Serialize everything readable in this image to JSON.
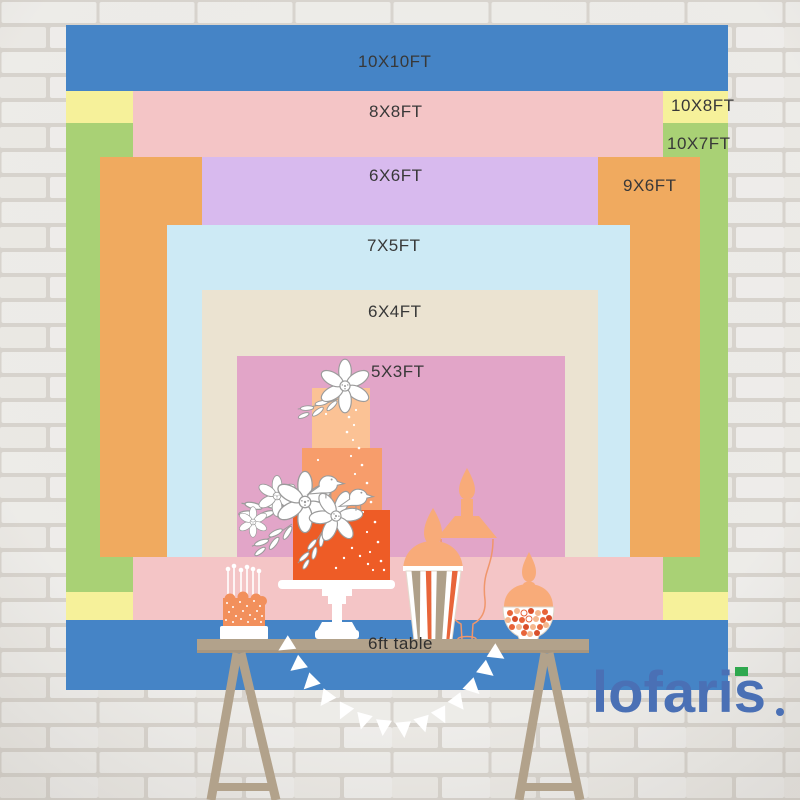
{
  "page": {
    "description": "backdrop size comparison chart on white brick wall with dessert table illustration"
  },
  "size_chart": {
    "layers": [
      {
        "label": "10X10FT",
        "color": "#4584c6"
      },
      {
        "label": "8X8FT",
        "color": "#f4c5c6"
      },
      {
        "label": "10X8FT",
        "color": "#f6f19a"
      },
      {
        "label": "10X7FT",
        "color": "#a9d175"
      },
      {
        "label": "6X6FT",
        "color": "#d8baee"
      },
      {
        "label": "9X6FT",
        "color": "#f0aa5f"
      },
      {
        "label": "7X5FT",
        "color": "#cdeaf5"
      },
      {
        "label": "6X4FT",
        "color": "#ebe3d1"
      },
      {
        "label": "5X3FT",
        "color": "#e2a5c8"
      }
    ],
    "table_label": "6ft table",
    "text_color": "#383838"
  },
  "brand": {
    "name": "lofaris",
    "color": "#4a70b5",
    "accent_green": "#2fa84e"
  },
  "scene": {
    "illustrations": [
      "white-brick-wall",
      "tiered-cake",
      "candle-cake",
      "popcorn-box",
      "apothecary-jar",
      "candy-jar",
      "trestle-table",
      "pennant-bunting"
    ],
    "cake_colors": [
      "#fbc295",
      "#f79d6b",
      "#ee5c26"
    ],
    "table_color": "#b2a28b",
    "lid_color": "#f8ab79"
  }
}
